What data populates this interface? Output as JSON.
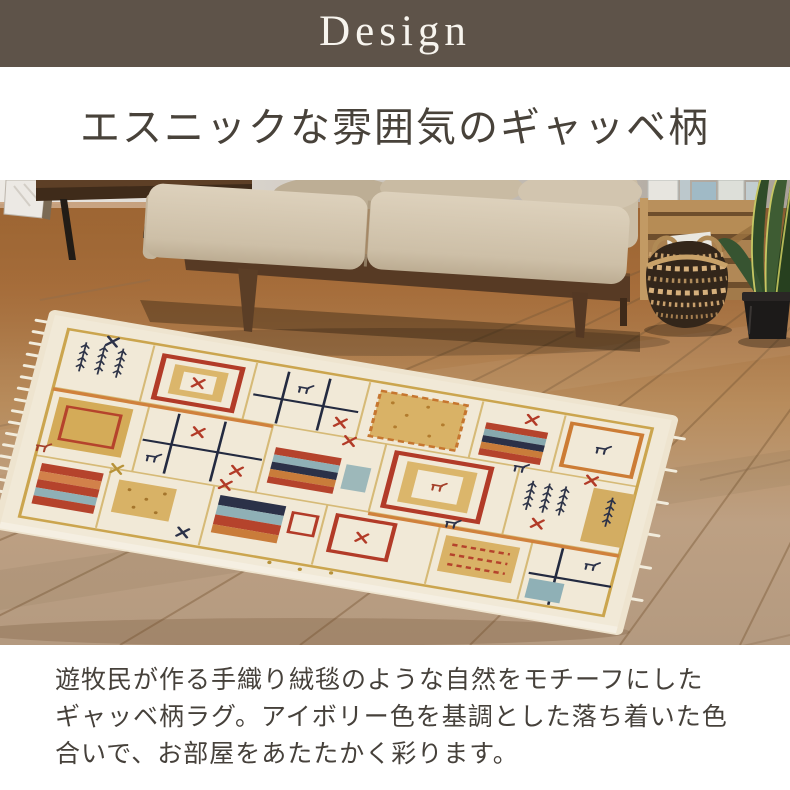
{
  "banner": {
    "label": "Design"
  },
  "heading": {
    "text": "エスニックな雰囲気のギャッベ柄"
  },
  "photo": {
    "objects": [
      "wall",
      "wood-floor",
      "leaning-mirror",
      "wooden-sideboard",
      "beige-sofa",
      "magazine-crate",
      "seagrass-basket",
      "snake-plant",
      "gabbeh-rug"
    ]
  },
  "description": {
    "lines": [
      "遊牧民が作る手織り絨毯のような自然をモチーフにした",
      "ギャッベ柄ラグ。アイボリー色を基調とした落ち着いた色",
      "合いで、お部屋をあたたかく彩ります。"
    ]
  },
  "colors": {
    "banner_bg": "#5e5349",
    "banner_text": "#f7f4ee",
    "heading_text": "#48423a",
    "body_text": "#46413b",
    "page_bg": "#ffffff",
    "rug_ivory": "#f1e9d7",
    "rug_red": "#b23b28",
    "rug_orange": "#cc7c35",
    "rug_gold": "#c79d3f",
    "rug_navy": "#2b3148",
    "sofa_beige": "#d2c5af",
    "floor_brown": "#a87342"
  }
}
